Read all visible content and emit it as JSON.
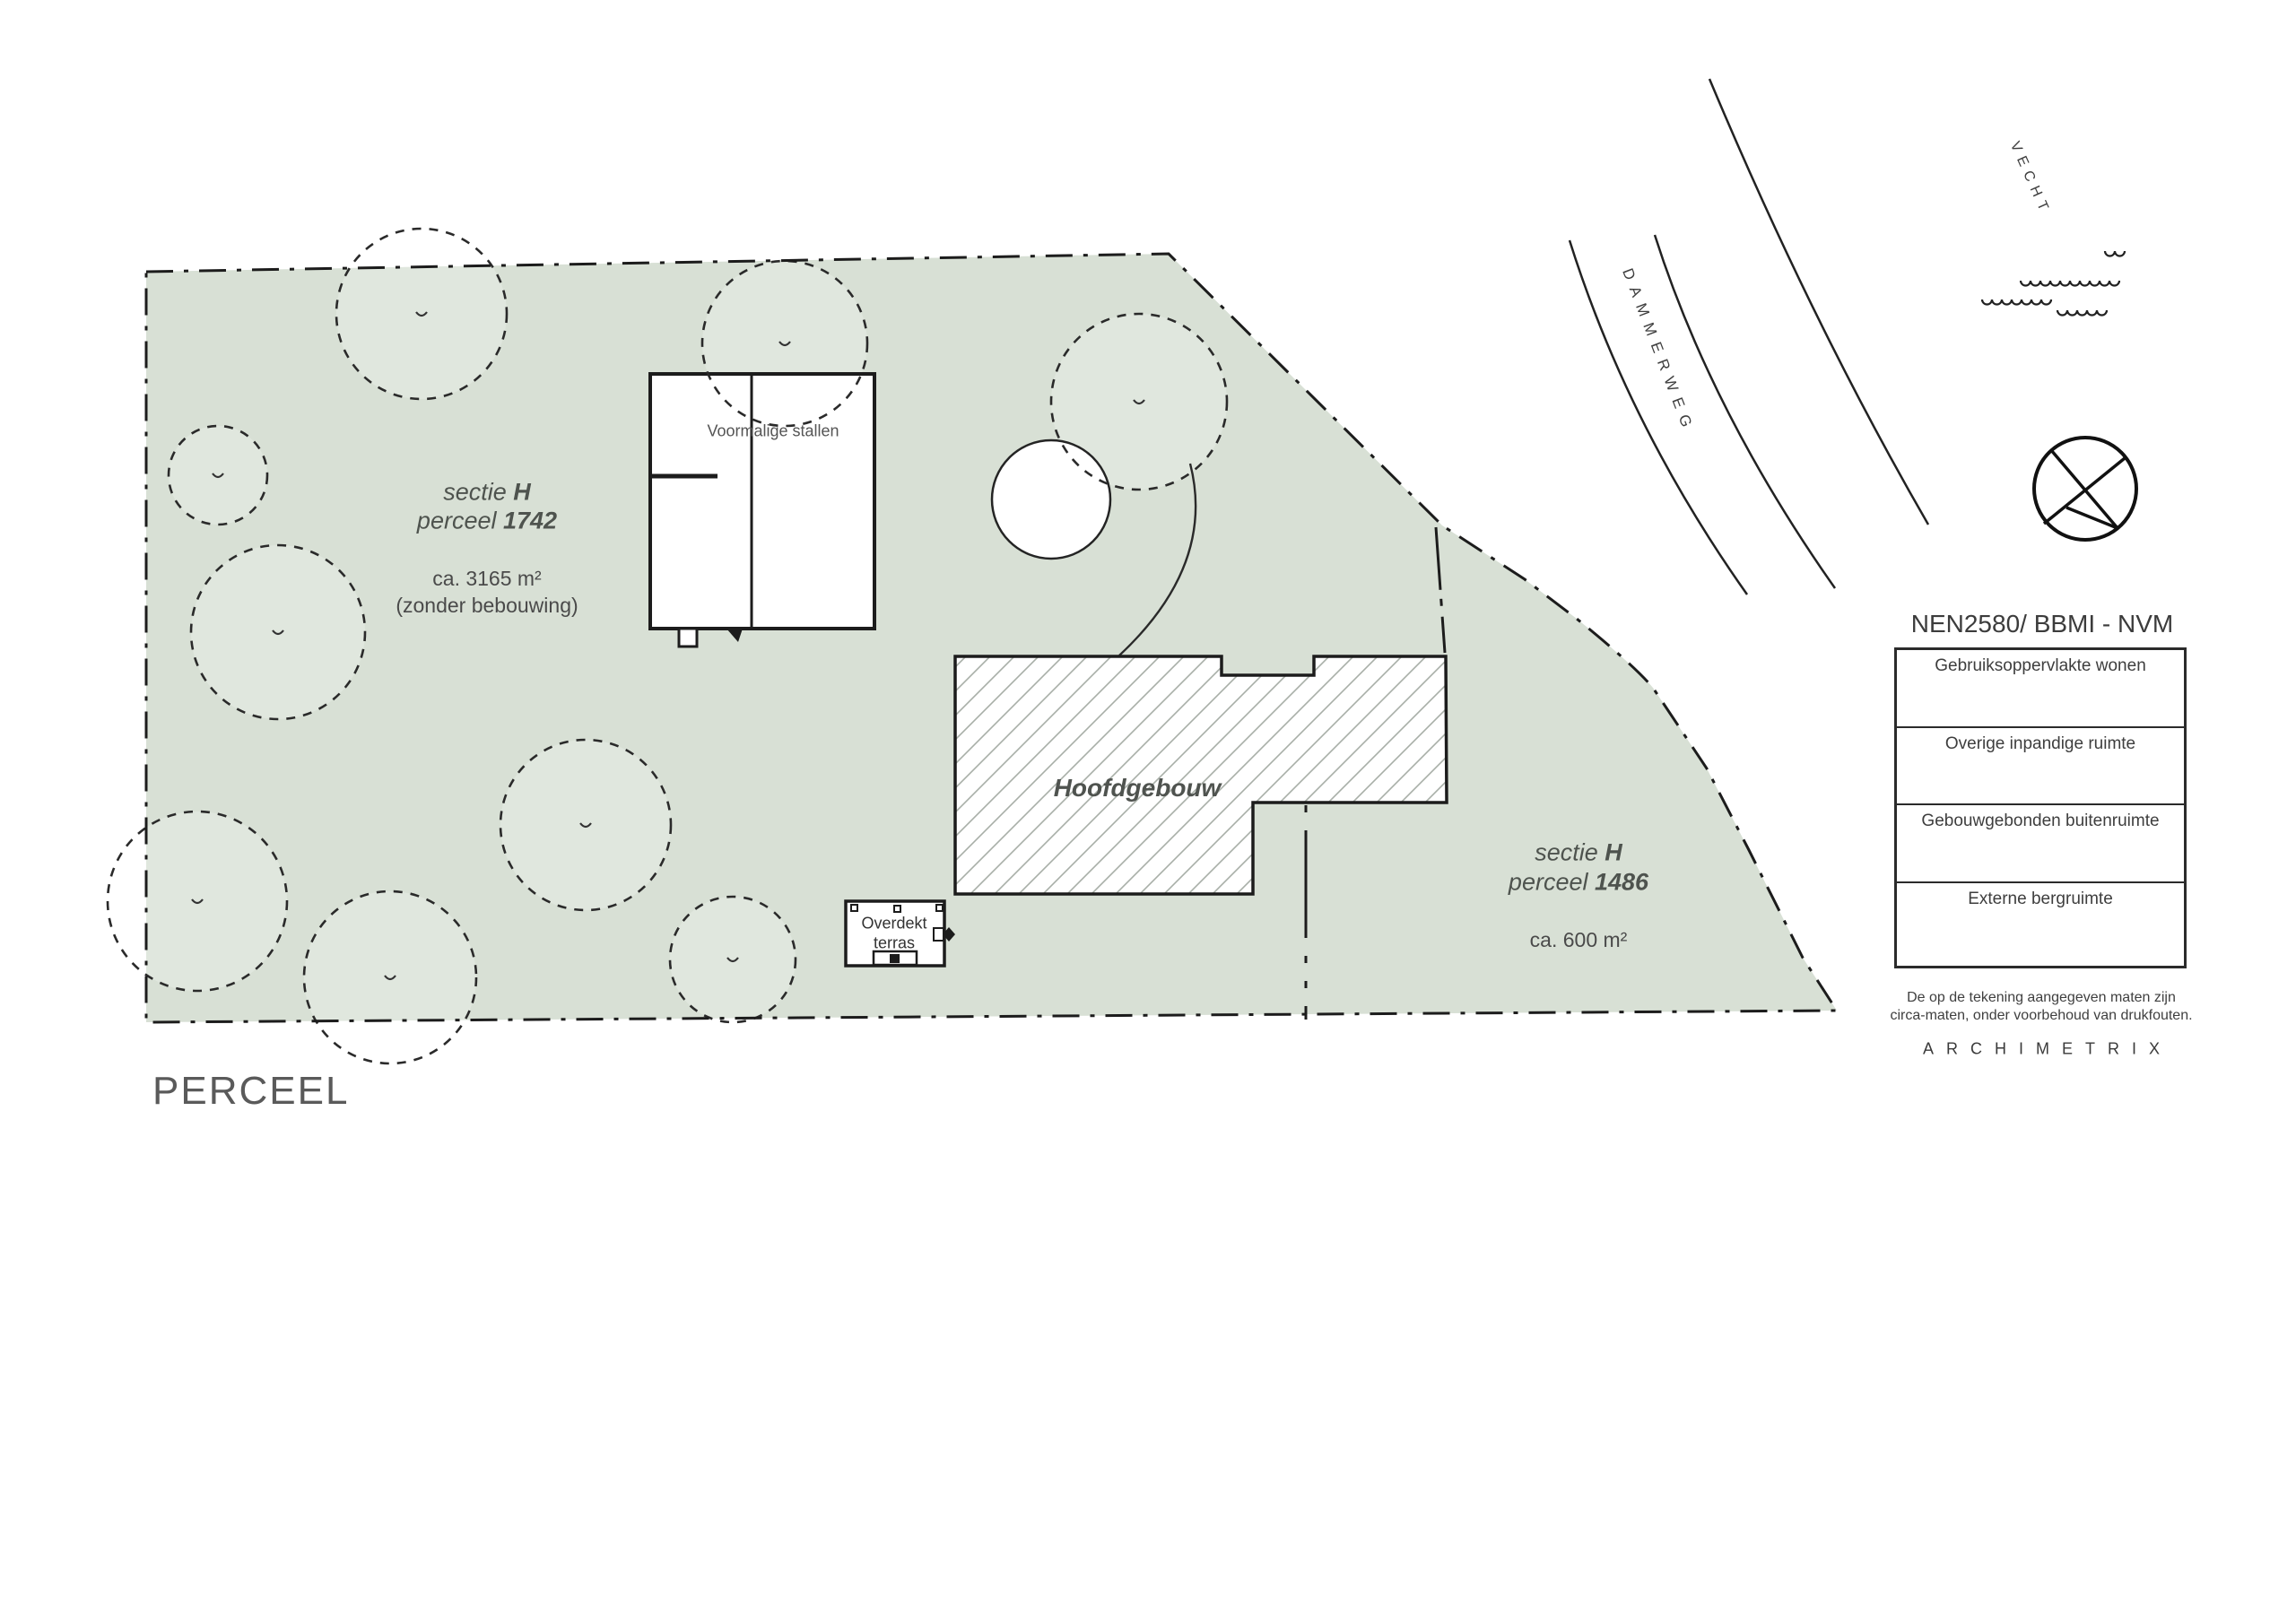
{
  "title": "PERCEEL",
  "parcels": {
    "p1742": {
      "section": "sectie ",
      "section_bold": "H",
      "parcel": "perceel ",
      "parcel_bold": "1742",
      "area": "ca. 3165 m²",
      "note": "(zonder bebouwing)"
    },
    "p1486": {
      "section": "sectie ",
      "section_bold": "H",
      "parcel": "perceel ",
      "parcel_bold": "1486",
      "area": "ca. 600 m²"
    }
  },
  "buildings": {
    "stables": "Voormalige stallen",
    "main": "Hoofdgebouw",
    "terrace_l1": "Overdekt",
    "terrace_l2": "terras"
  },
  "labels": {
    "road": "DAMMERWEG",
    "river": "VECHT"
  },
  "legend": {
    "title": "NEN2580/ BBMI - NVM",
    "rows": [
      "Gebruiksoppervlakte wonen",
      "Overige inpandige ruimte",
      "Gebouwgebonden buitenruimte",
      "Externe bergruimte"
    ],
    "disclaimer_l1": "De op de tekening aangegeven maten zijn",
    "disclaimer_l2": "circa-maten, onder voorbehoud van drukfouten.",
    "brand": "ARCHIMETRIX"
  },
  "colors": {
    "parcel_fill": "#d8e0d5",
    "tree_fill": "#e0e7de",
    "line": "#1c1c1c",
    "text": "#4e534e"
  }
}
